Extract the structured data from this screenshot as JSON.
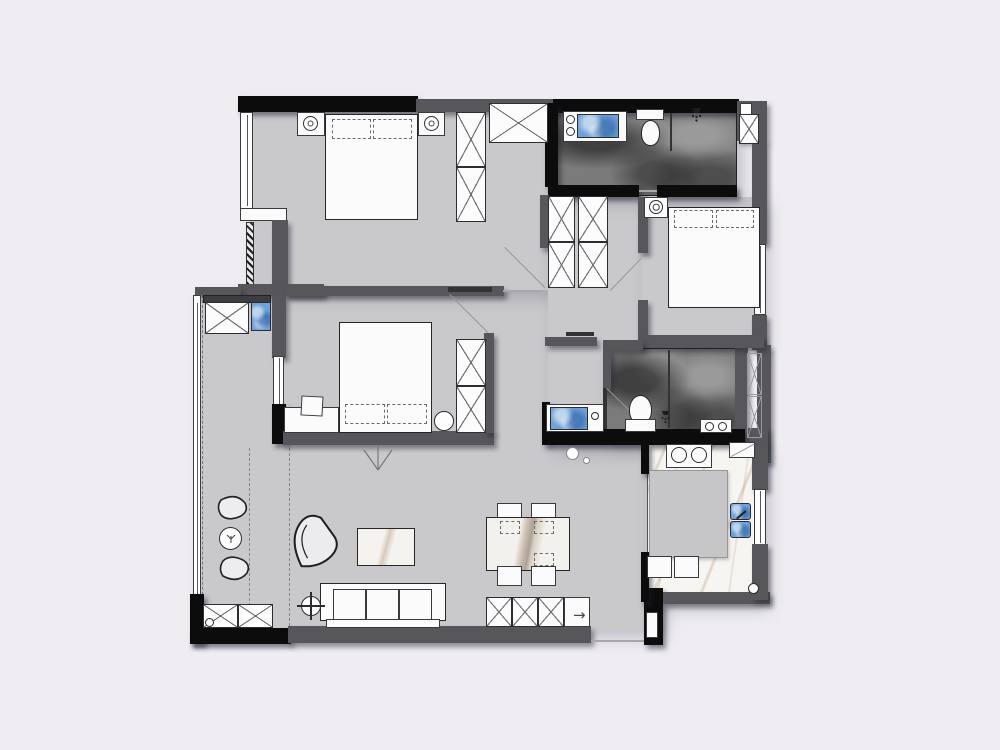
{
  "colors": {
    "background": "#efedf2",
    "floor": "#c9c9cc",
    "floor_dark_base": "#7b7b7b",
    "floor_kitchen_base": "#f7f5f1",
    "wall": "#57575b",
    "wall_black": "#0c0c0c",
    "furniture": "#fbfbfc",
    "sink_blue": "#6fa3d8",
    "marble_vein_tan": "#8c643c",
    "dashed_line": "#85858b"
  },
  "icons": {
    "entry_arrow": "→",
    "shower_head": "shower-head-icon",
    "ceiling_light": "ceiling-light-icon",
    "floor_lamp": "floor-lamp-icon",
    "wardrobe_cross": "wardrobe-x-icon"
  }
}
